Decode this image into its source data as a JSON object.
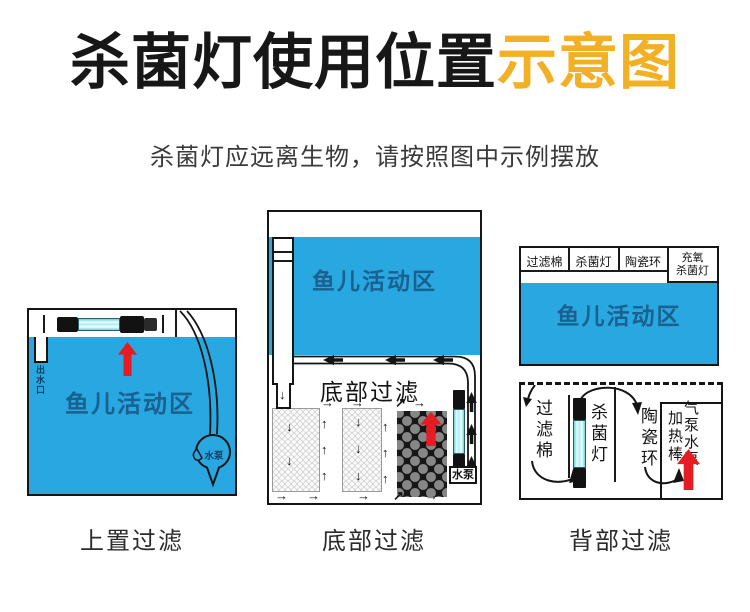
{
  "title": {
    "main": "杀菌灯使用位置",
    "highlight": "示意图"
  },
  "subtitle": "杀菌灯应远离生物，请按照图中示例摆放",
  "colors": {
    "water_blue": "#29a7e0",
    "highlight_yellow": "#f2b024",
    "arrow_red": "#e51c23",
    "lamp_cyan": "#aeeef0",
    "water_text_blue": "#19618f"
  },
  "icons": {
    "up_arrow": "↑",
    "down_arrow": "↓",
    "left_arrow": "←",
    "right_arrow": "→",
    "up_right_arrow": "↗"
  },
  "diagrams": {
    "top_filter": {
      "caption": "上置过滤",
      "fish_zone": "鱼儿活动区",
      "outlet": "出水口",
      "pump": "水泵"
    },
    "bottom_filter": {
      "caption": "底部过滤",
      "fish_zone": "鱼儿活动区",
      "section_title": "底部过滤",
      "pump": "水泵"
    },
    "back_filter": {
      "caption": "背部过滤",
      "fish_zone": "鱼儿活动区",
      "header_cells": [
        {
          "lines": [
            "过滤棉"
          ]
        },
        {
          "lines": [
            "杀菌灯"
          ]
        },
        {
          "lines": [
            "陶瓷环"
          ]
        },
        {
          "lines": [
            "充氧",
            "杀菌灯"
          ]
        }
      ],
      "side_labels": {
        "filter_cotton": "过滤棉",
        "uv_lamp": "杀菌灯",
        "ceramic_rings": "陶瓷环",
        "heater": "加热棒",
        "pumps": "气泵水泵"
      }
    }
  }
}
